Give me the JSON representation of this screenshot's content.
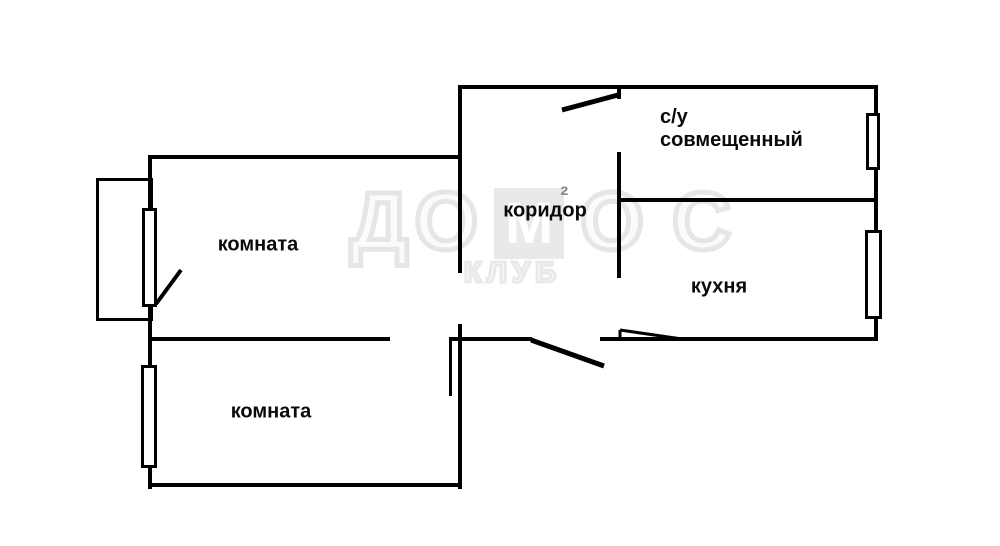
{
  "plan": {
    "rooms": {
      "room_top": "комната",
      "room_bottom": "комната",
      "corridor": "коридор",
      "bathroom_line1": "с/у",
      "bathroom_line2": "совмещенный",
      "kitchen": "кухня"
    }
  },
  "watermark": {
    "letters": [
      "Д",
      "О",
      "М",
      "О",
      "С"
    ],
    "sup": "²",
    "club": "КЛУБ"
  },
  "colors": {
    "wall": "#000000",
    "background": "#ffffff",
    "watermark_gray": "#e6e6e6",
    "watermark_sup_gray": "#8a8a8a",
    "label_text": "#0a0a0a"
  }
}
